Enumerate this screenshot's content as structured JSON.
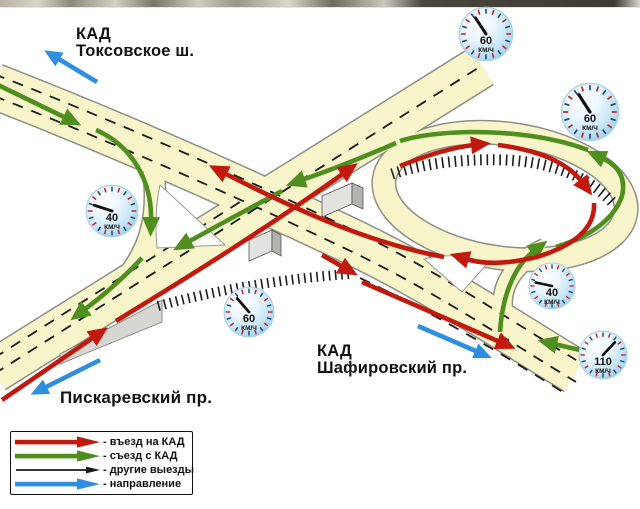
{
  "labels": {
    "kad_toksovskoe": {
      "line1": "КАД",
      "line2": "Токсовское ш."
    },
    "piskarevsky": {
      "text": "Пискаревский пр."
    },
    "kad_shafirovsky": {
      "line1": "КАД",
      "line2": "Шафировский пр."
    }
  },
  "gauges": [
    {
      "value": "60",
      "unit": "КМ/Ч"
    },
    {
      "value": "60",
      "unit": "КМ/Ч"
    },
    {
      "value": "40",
      "unit": "КМ/Ч"
    },
    {
      "value": "60",
      "unit": "КМ/Ч"
    },
    {
      "value": "40",
      "unit": "КМ/Ч"
    },
    {
      "value": "110",
      "unit": "КМ/Ч"
    }
  ],
  "legend": {
    "items": [
      {
        "key": "entry",
        "label": "- въезд на КАД",
        "color": "#c2190f"
      },
      {
        "key": "exit",
        "label": "- съезд с КАД",
        "color": "#4f8f1d"
      },
      {
        "key": "other",
        "label": "- другие выезды",
        "color": "#1a1a1a"
      },
      {
        "key": "direction",
        "label": "- направление",
        "color": "#2e8ee0"
      }
    ]
  },
  "colors": {
    "road_fill": "#f8f5cb",
    "road_edge": "#8f8f88",
    "entry_red": "#c2190f",
    "exit_green": "#4f8f1d",
    "direction_blue": "#2e8ee0",
    "other_black": "#1a1a1a",
    "gauge_face": "#c3e4f6"
  }
}
